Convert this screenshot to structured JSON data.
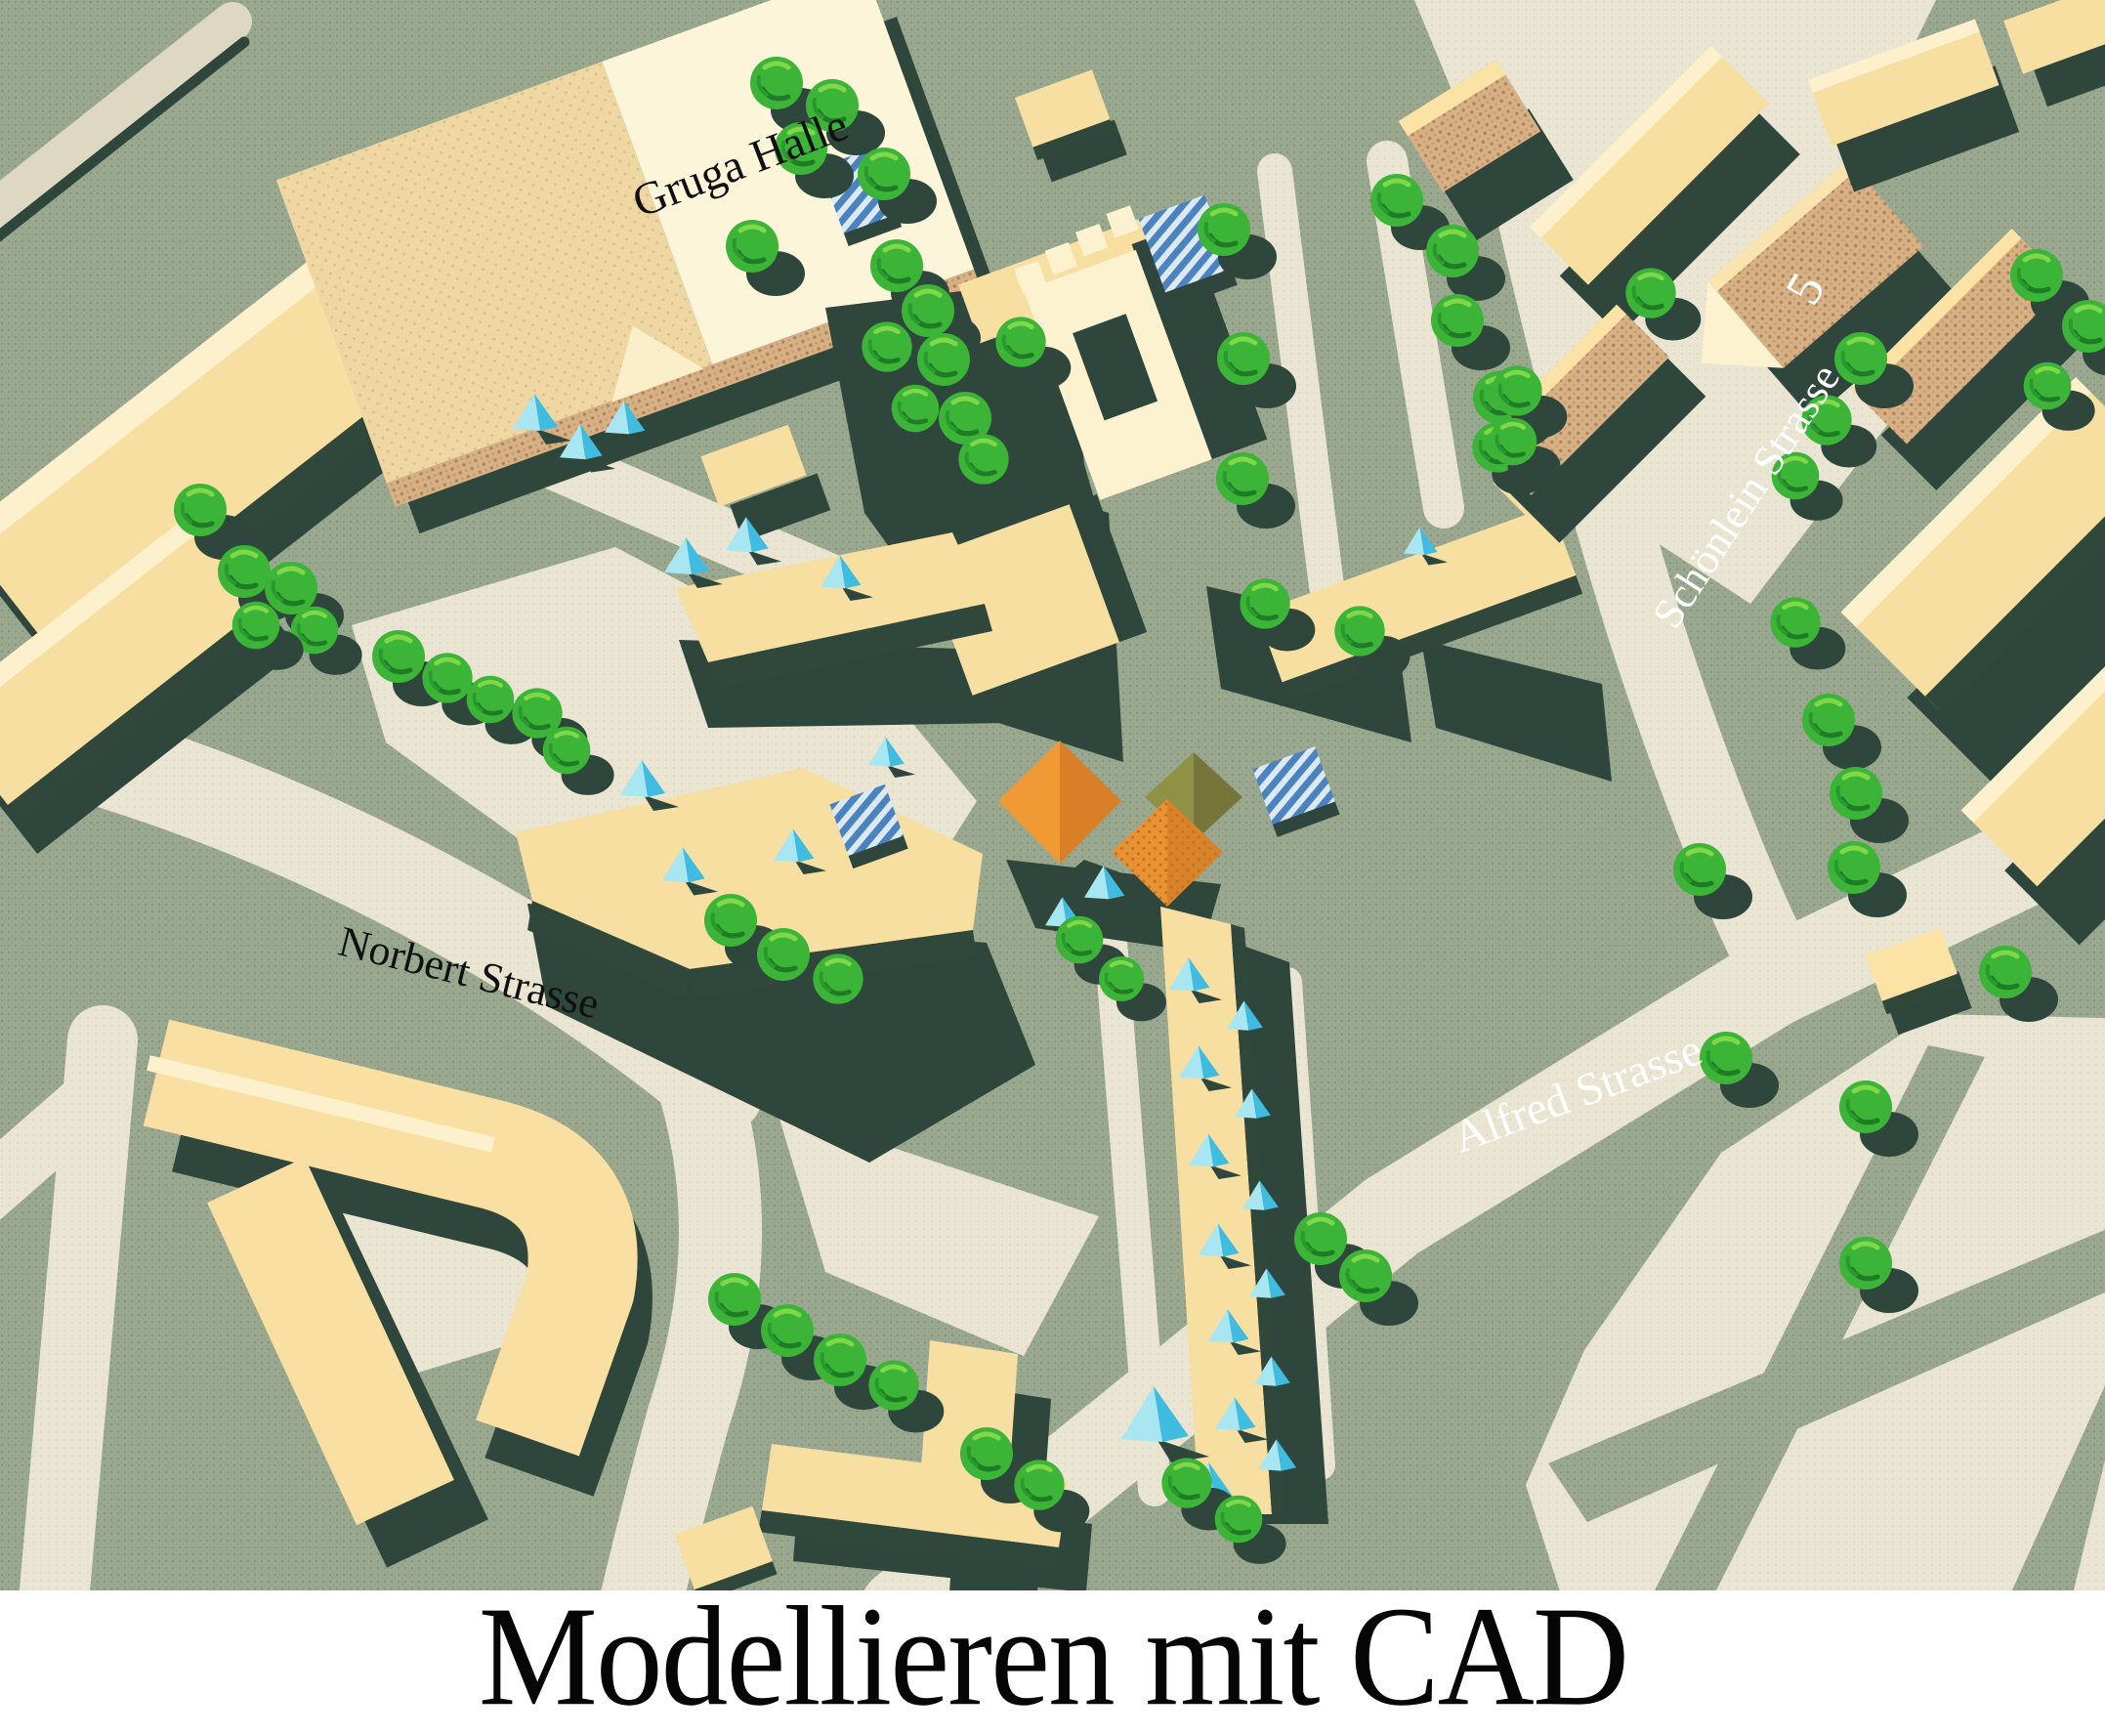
{
  "caption": {
    "title": "Modellieren mit CAD"
  },
  "map_labels": {
    "gruga_halle": {
      "text": "Gruga Halle",
      "color": "#101010"
    },
    "norbert_strasse": {
      "text": "Norbert Strasse",
      "color": "#101010"
    },
    "schoenlein_strasse": {
      "text": "Schönlein Strasse",
      "color": "#ffffff"
    },
    "alfred_strasse": {
      "text": "Alfred Strasse",
      "color": "#ffffff"
    },
    "house_number_5": {
      "text": "5",
      "color": "#ffffff"
    }
  },
  "palette": {
    "ground_sage": "#9aa890",
    "road_cream": "#e9e5d2",
    "shadow_green": "#2e463b",
    "roof_yellow": "#f7dfa2",
    "roof_cream": "#fdf5da",
    "wall_tan": "#d7b084",
    "tree_green": "#3bb437",
    "tree_highlight": "#7fd84a",
    "canopy_cyan": "#3fbcdf",
    "glass_blue": "#4b83c0",
    "tent_orange": "#f09a36",
    "tent_olive": "#8f9145",
    "caption_background": "#ffffff",
    "caption_text": "#060606"
  }
}
